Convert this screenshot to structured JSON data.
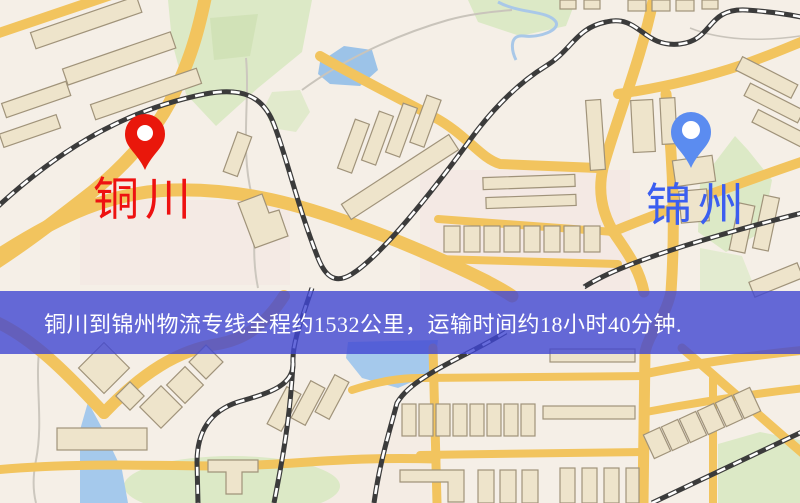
{
  "map": {
    "origin": {
      "label": "铜川",
      "pin_color": "#e9170b",
      "label_color": "#ee1111"
    },
    "destination": {
      "label": "锦州",
      "pin_color": "#5b8cf0",
      "label_color": "#3b5ef0"
    }
  },
  "banner": {
    "text": "铜川到锦州物流专线全程约1532公里，运输时间约18小时40分钟.",
    "background": "rgba(64,70,210,0.8)",
    "text_color": "#ffffff"
  },
  "palette": {
    "map_background": "#f5efe7",
    "road_yellow": "#f2c45e",
    "building_fill": "#eee4cb",
    "building_stroke": "#a0937a",
    "park_green": "#dce9c6",
    "water_blue": "#9cc3e8",
    "railway_dark": "#3b3b3b",
    "railway_dash": "#ffffff"
  }
}
